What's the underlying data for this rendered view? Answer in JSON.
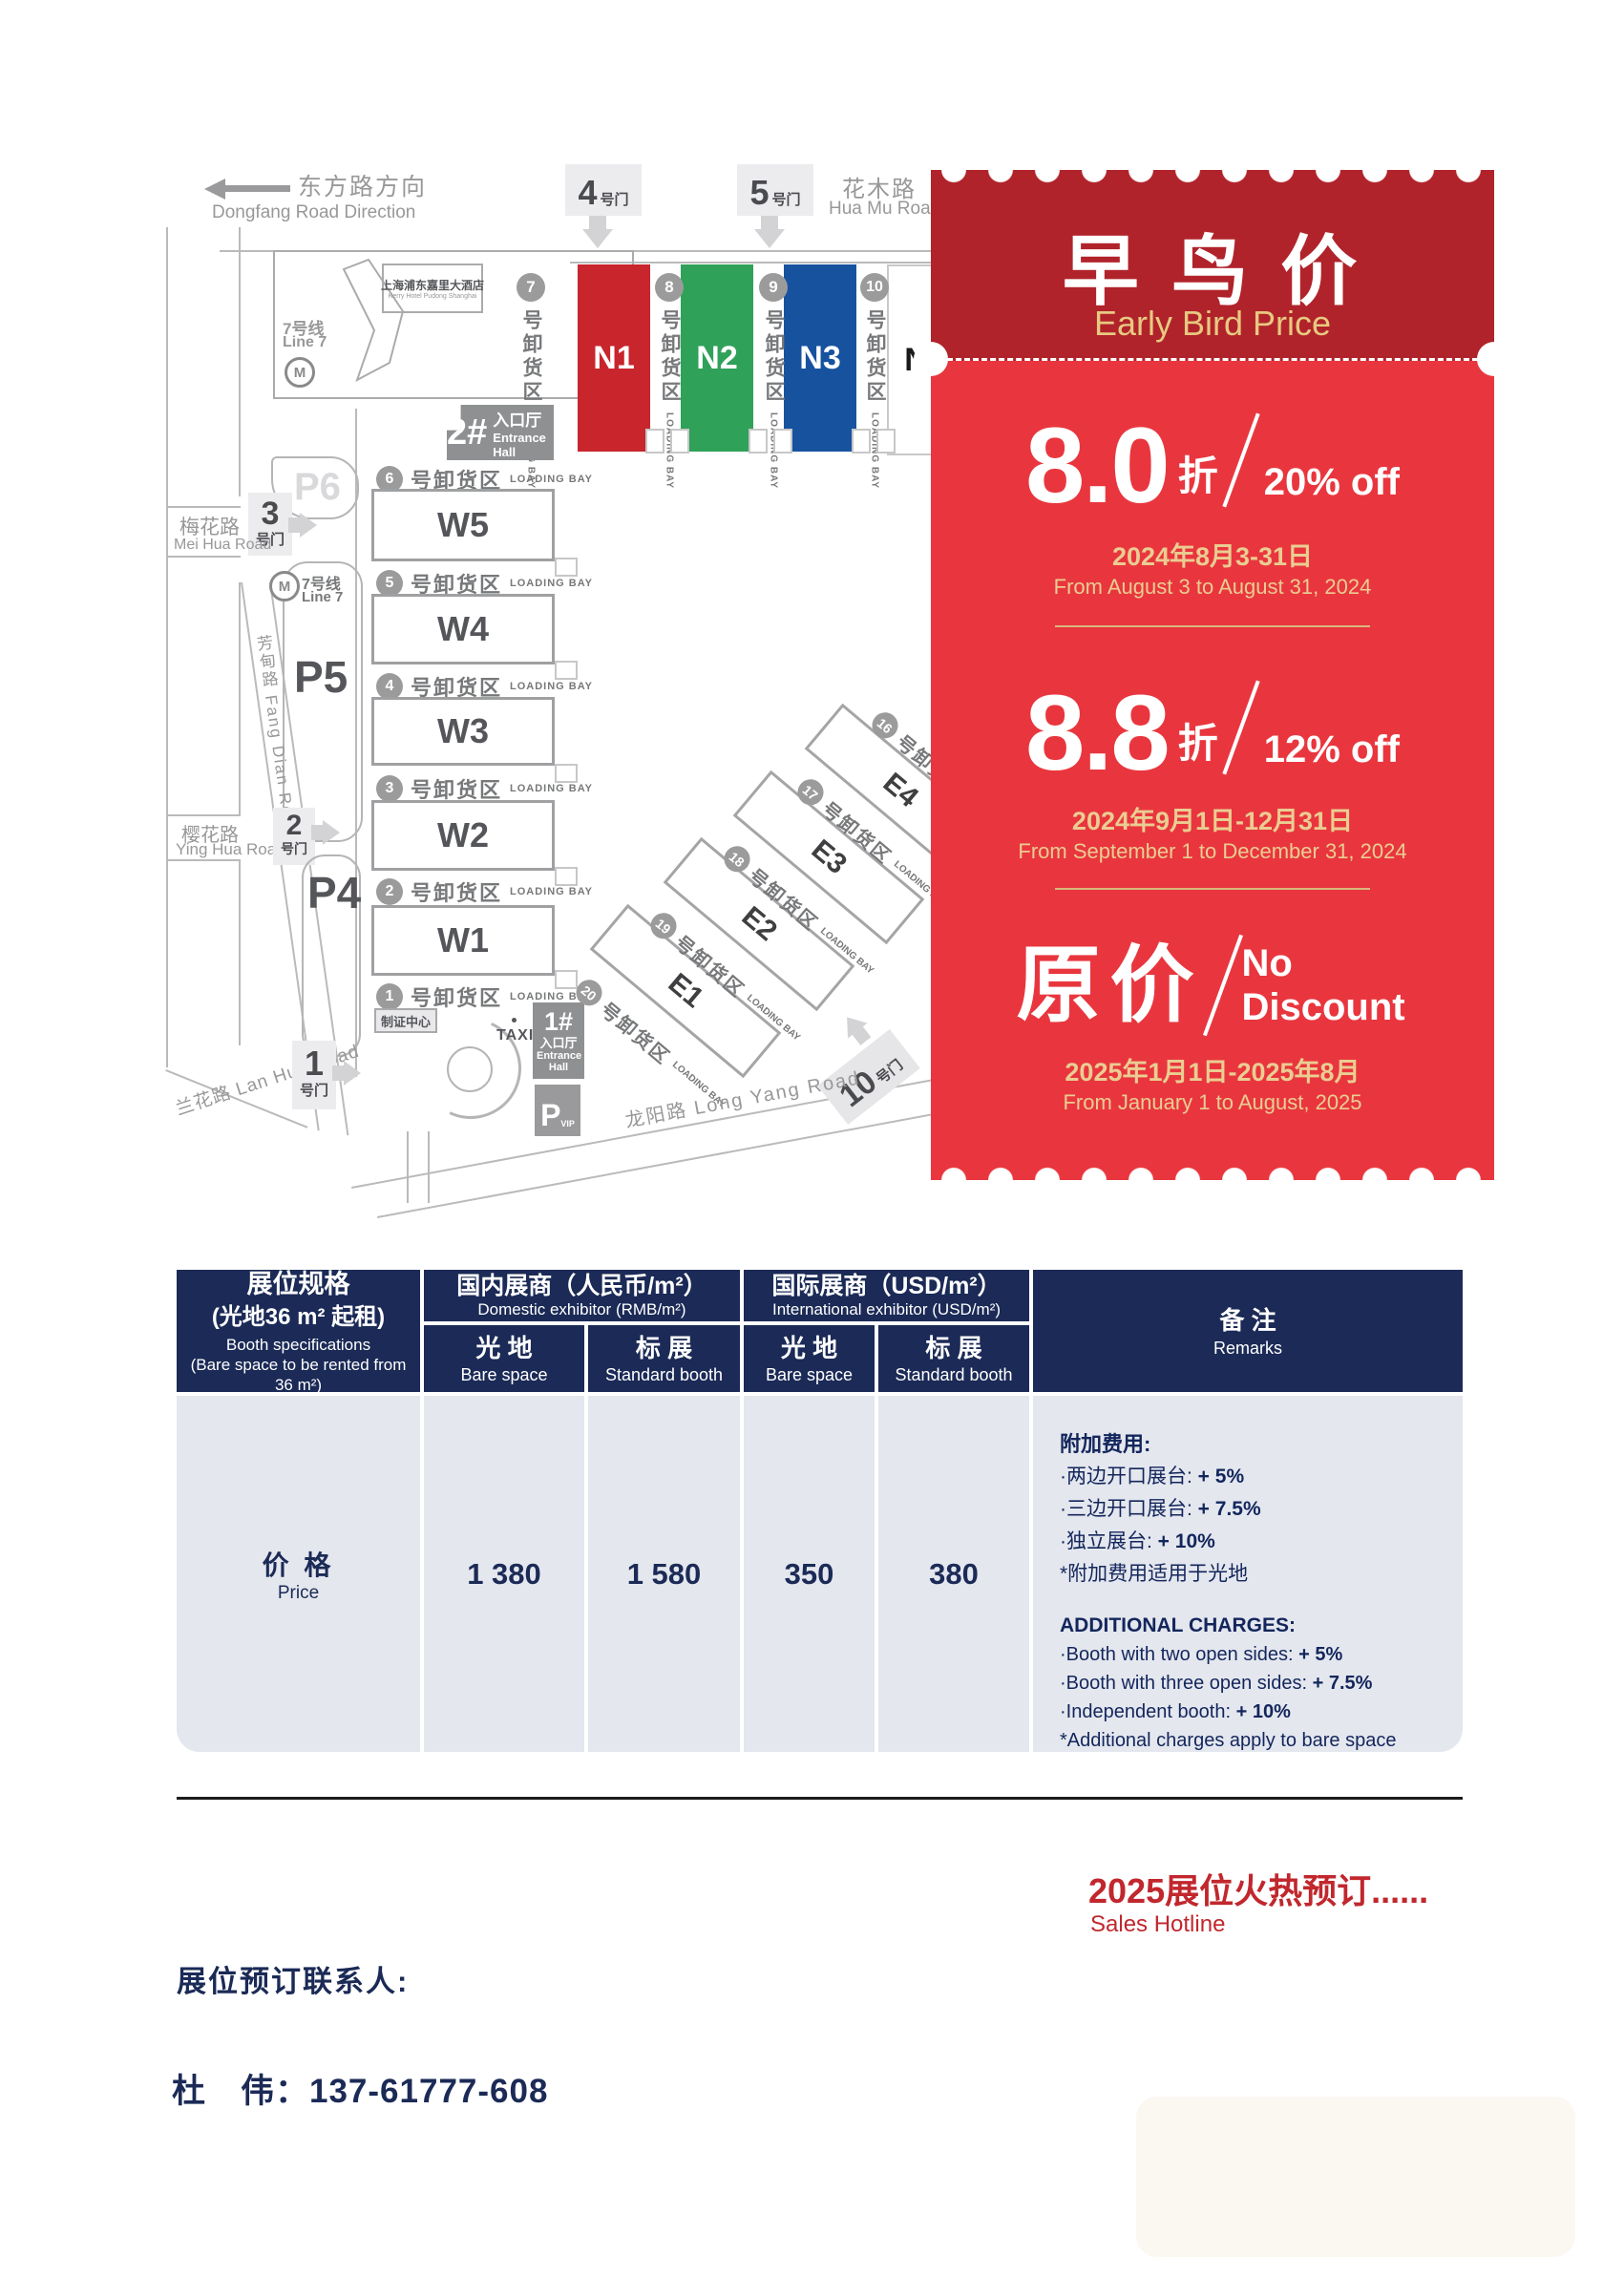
{
  "colors": {
    "red_dark": "#B1232B",
    "red_body": "#E9363E",
    "gold": "#EACD92",
    "navy": "#1B2A56",
    "table_gray": "#E4E7EE",
    "hall_n1": "#C8252D",
    "hall_n2": "#2FA158",
    "hall_n3": "#17529F",
    "promo_red_text": "#C1272D"
  },
  "map": {
    "direction_zh": "东方路方向",
    "direction_en": "Dongfang Road Direction",
    "huamu_zh": "花木路",
    "huamu_en": "Hua Mu Road",
    "meihua_zh": "梅花路",
    "meihua_en": "Mei Hua Road",
    "fangdian": "芳甸路 Fang Dian Road",
    "yinghua_zh": "樱花路",
    "yinghua_en": "Ying Hua Road",
    "lanhua": "兰花路 Lan Hua Road",
    "longyang": "龙阳路 Long Yang Road",
    "hotel_zh": "上海浦东嘉里大酒店",
    "hotel_en": "Kerry Hotel Pudong Shanghai",
    "line7_zh": "7号线",
    "line7_en": "Line 7",
    "gate_suffix": "号门",
    "gates": {
      "g1": "1",
      "g2": "2",
      "g3": "3",
      "g4": "4",
      "g5": "5",
      "g10": "10"
    },
    "entrance2_num": "2#",
    "entrance1_num": "1#",
    "entrance_zh": "入口厅",
    "entrance_en": "Entrance Hall",
    "zhizheng": "制证中心",
    "taxi": "TAXI",
    "p4": "P4",
    "p5": "P5",
    "p6": "P6",
    "pvip": "P",
    "pvip_sub": "VIP",
    "bay_zh": "号卸货区",
    "bay_en": "LOADING BAY",
    "n_halls": [
      "N1",
      "N2",
      "N3",
      "N4"
    ],
    "n_bays": [
      "7",
      "8",
      "9",
      "10"
    ],
    "w_halls": [
      "W5",
      "W4",
      "W3",
      "W2",
      "W1"
    ],
    "w_bays": [
      "6",
      "5",
      "4",
      "3",
      "2",
      "1"
    ],
    "e_halls": [
      "E4",
      "E3",
      "E2",
      "E1"
    ],
    "e_bays": [
      "16",
      "17",
      "18",
      "19",
      "20"
    ]
  },
  "promo": {
    "title_zh": "早 鸟 价",
    "title_en": "Early Bird Price",
    "tiers": [
      {
        "rate": "8.0",
        "zhe": "折",
        "off": "20% off",
        "date_zh": "2024年8月3-31日",
        "date_en": "From August 3 to August 31, 2024"
      },
      {
        "rate": "8.8",
        "zhe": "折",
        "off": "12% off",
        "date_zh": "2024年9月1日-12月31日",
        "date_en": "From September 1 to December 31, 2024"
      },
      {
        "rate": "原价",
        "off": "No Discount",
        "date_zh": "2025年1月1日-2025年8月",
        "date_en": "From January 1 to August, 2025"
      }
    ]
  },
  "table": {
    "spec": {
      "zh1": "展位规格",
      "zh2": "(光地36 m² 起租)",
      "en1": "Booth specifications",
      "en2": "(Bare space to be rented from 36 m²)"
    },
    "domestic": {
      "zh": "国内展商（人民币/m²）",
      "en": "Domestic exhibitor (RMB/m²)"
    },
    "intl": {
      "zh": "国际展商（USD/m²）",
      "en": "International exhibitor (USD/m²)"
    },
    "sub_bare_zh": "光 地",
    "sub_bare_en": "Bare space",
    "sub_std_zh": "标 展",
    "sub_std_en": "Standard booth",
    "remarks_zh": "备 注",
    "remarks_en": "Remarks",
    "row": {
      "label_zh": "价 格",
      "label_en": "Price",
      "values": [
        "1 380",
        "1 580",
        "350",
        "380"
      ]
    },
    "remarks_body": {
      "zh_title": "附加费用:",
      "zh_lines": [
        {
          "label": "·两边开口展台: ",
          "value": "+ 5%"
        },
        {
          "label": "·三边开口展台: ",
          "value": "+ 7.5%"
        },
        {
          "label": "·独立展台: ",
          "value": "+ 10%"
        }
      ],
      "zh_note": "*附加费用适用于光地",
      "en_title": "ADDITIONAL CHARGES:",
      "en_lines": [
        {
          "label": "·Booth with two open sides: ",
          "value": "+ 5%"
        },
        {
          "label": "·Booth with three open sides: ",
          "value": "+ 7.5%"
        },
        {
          "label": "·Independent booth: ",
          "value": "+ 10%"
        }
      ],
      "en_note": "*Additional charges apply to bare space"
    }
  },
  "footer": {
    "promo_zh": "2025展位火热预订......",
    "hotline": "Sales Hotline",
    "contact_label": "展位预订联系人:",
    "contact_phone": "杜　伟：137-61777-608"
  }
}
